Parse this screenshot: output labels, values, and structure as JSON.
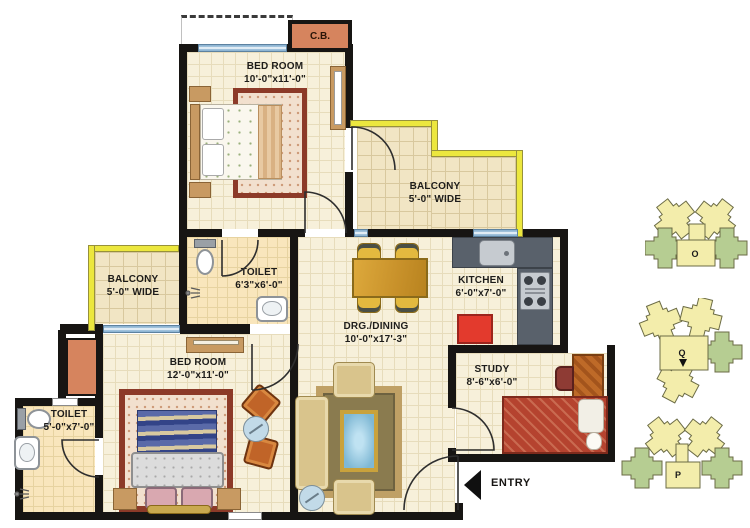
{
  "rooms": {
    "bedroom1": {
      "name": "BED ROOM",
      "dims": "10'-0\"x11'-0\""
    },
    "balcony_right": {
      "name": "BALCONY",
      "dims": "5'-0\" WIDE"
    },
    "balcony_left": {
      "name": "BALCONY",
      "dims": "5'-0\" WIDE"
    },
    "toilet1": {
      "name": "TOILET",
      "dims": "6'3\"x6'-0\""
    },
    "kitchen": {
      "name": "KITCHEN",
      "dims": "6'-0\"x7'-0\""
    },
    "drg_dining": {
      "name": "DRG./DINING",
      "dims": "10'-0\"x17'-3\""
    },
    "bedroom2": {
      "name": "BED ROOM",
      "dims": "12'-0\"x11'-0\""
    },
    "toilet2": {
      "name": "TOILET",
      "dims": "5'-0\"x7'-0\""
    },
    "study": {
      "name": "STUDY",
      "dims": "8'-6\"x6'-0\""
    }
  },
  "annotations": {
    "cupboard": "C.B.",
    "entry": "ENTRY"
  },
  "key_plan": {
    "towers": [
      {
        "label": "O"
      },
      {
        "label": "Q"
      },
      {
        "label": "P"
      }
    ]
  },
  "colors": {
    "wall": "#171513",
    "balcony_wall": "#ECE73E",
    "floor": "#F7F0DA",
    "toilet_floor": "#F9E6BC",
    "cupboard_orange": "#D6845E",
    "window_blue": "#8FB6D4",
    "kitchen_counter": "#59616B",
    "fridge_red": "#E33A2D",
    "cluster_yellow": "#F3EDAB",
    "cluster_green": "#B6CD92"
  }
}
